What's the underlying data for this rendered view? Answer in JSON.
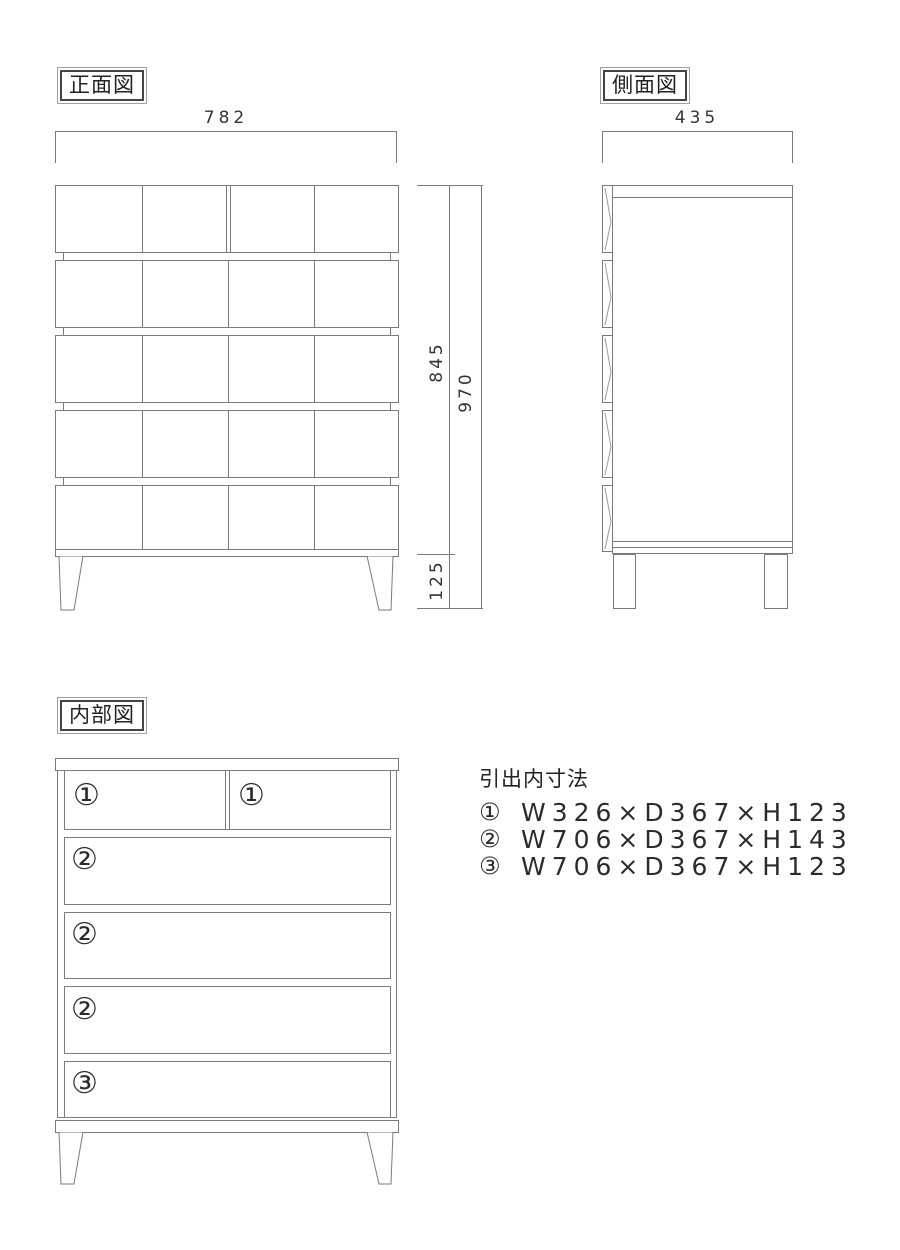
{
  "colors": {
    "line": "#7a7a7a",
    "text": "#333333"
  },
  "front_view": {
    "label": "正面図",
    "width_dim": "782",
    "body_height_dim": "845",
    "total_height_dim": "970",
    "leg_height_dim": "125"
  },
  "side_view": {
    "label": "側面図",
    "depth_dim": "435"
  },
  "internal_view": {
    "label": "内部図",
    "rows": [
      {
        "cells": [
          "①",
          "①"
        ]
      },
      {
        "cells": [
          "②"
        ]
      },
      {
        "cells": [
          "②"
        ]
      },
      {
        "cells": [
          "②"
        ]
      },
      {
        "cells": [
          "③"
        ]
      }
    ]
  },
  "dimensions_list": {
    "title": "引出内寸法",
    "items": [
      {
        "marker": "①",
        "text": "W326×D367×H123"
      },
      {
        "marker": "②",
        "text": "W706×D367×H143"
      },
      {
        "marker": "③",
        "text": "W706×D367×H123"
      }
    ]
  }
}
